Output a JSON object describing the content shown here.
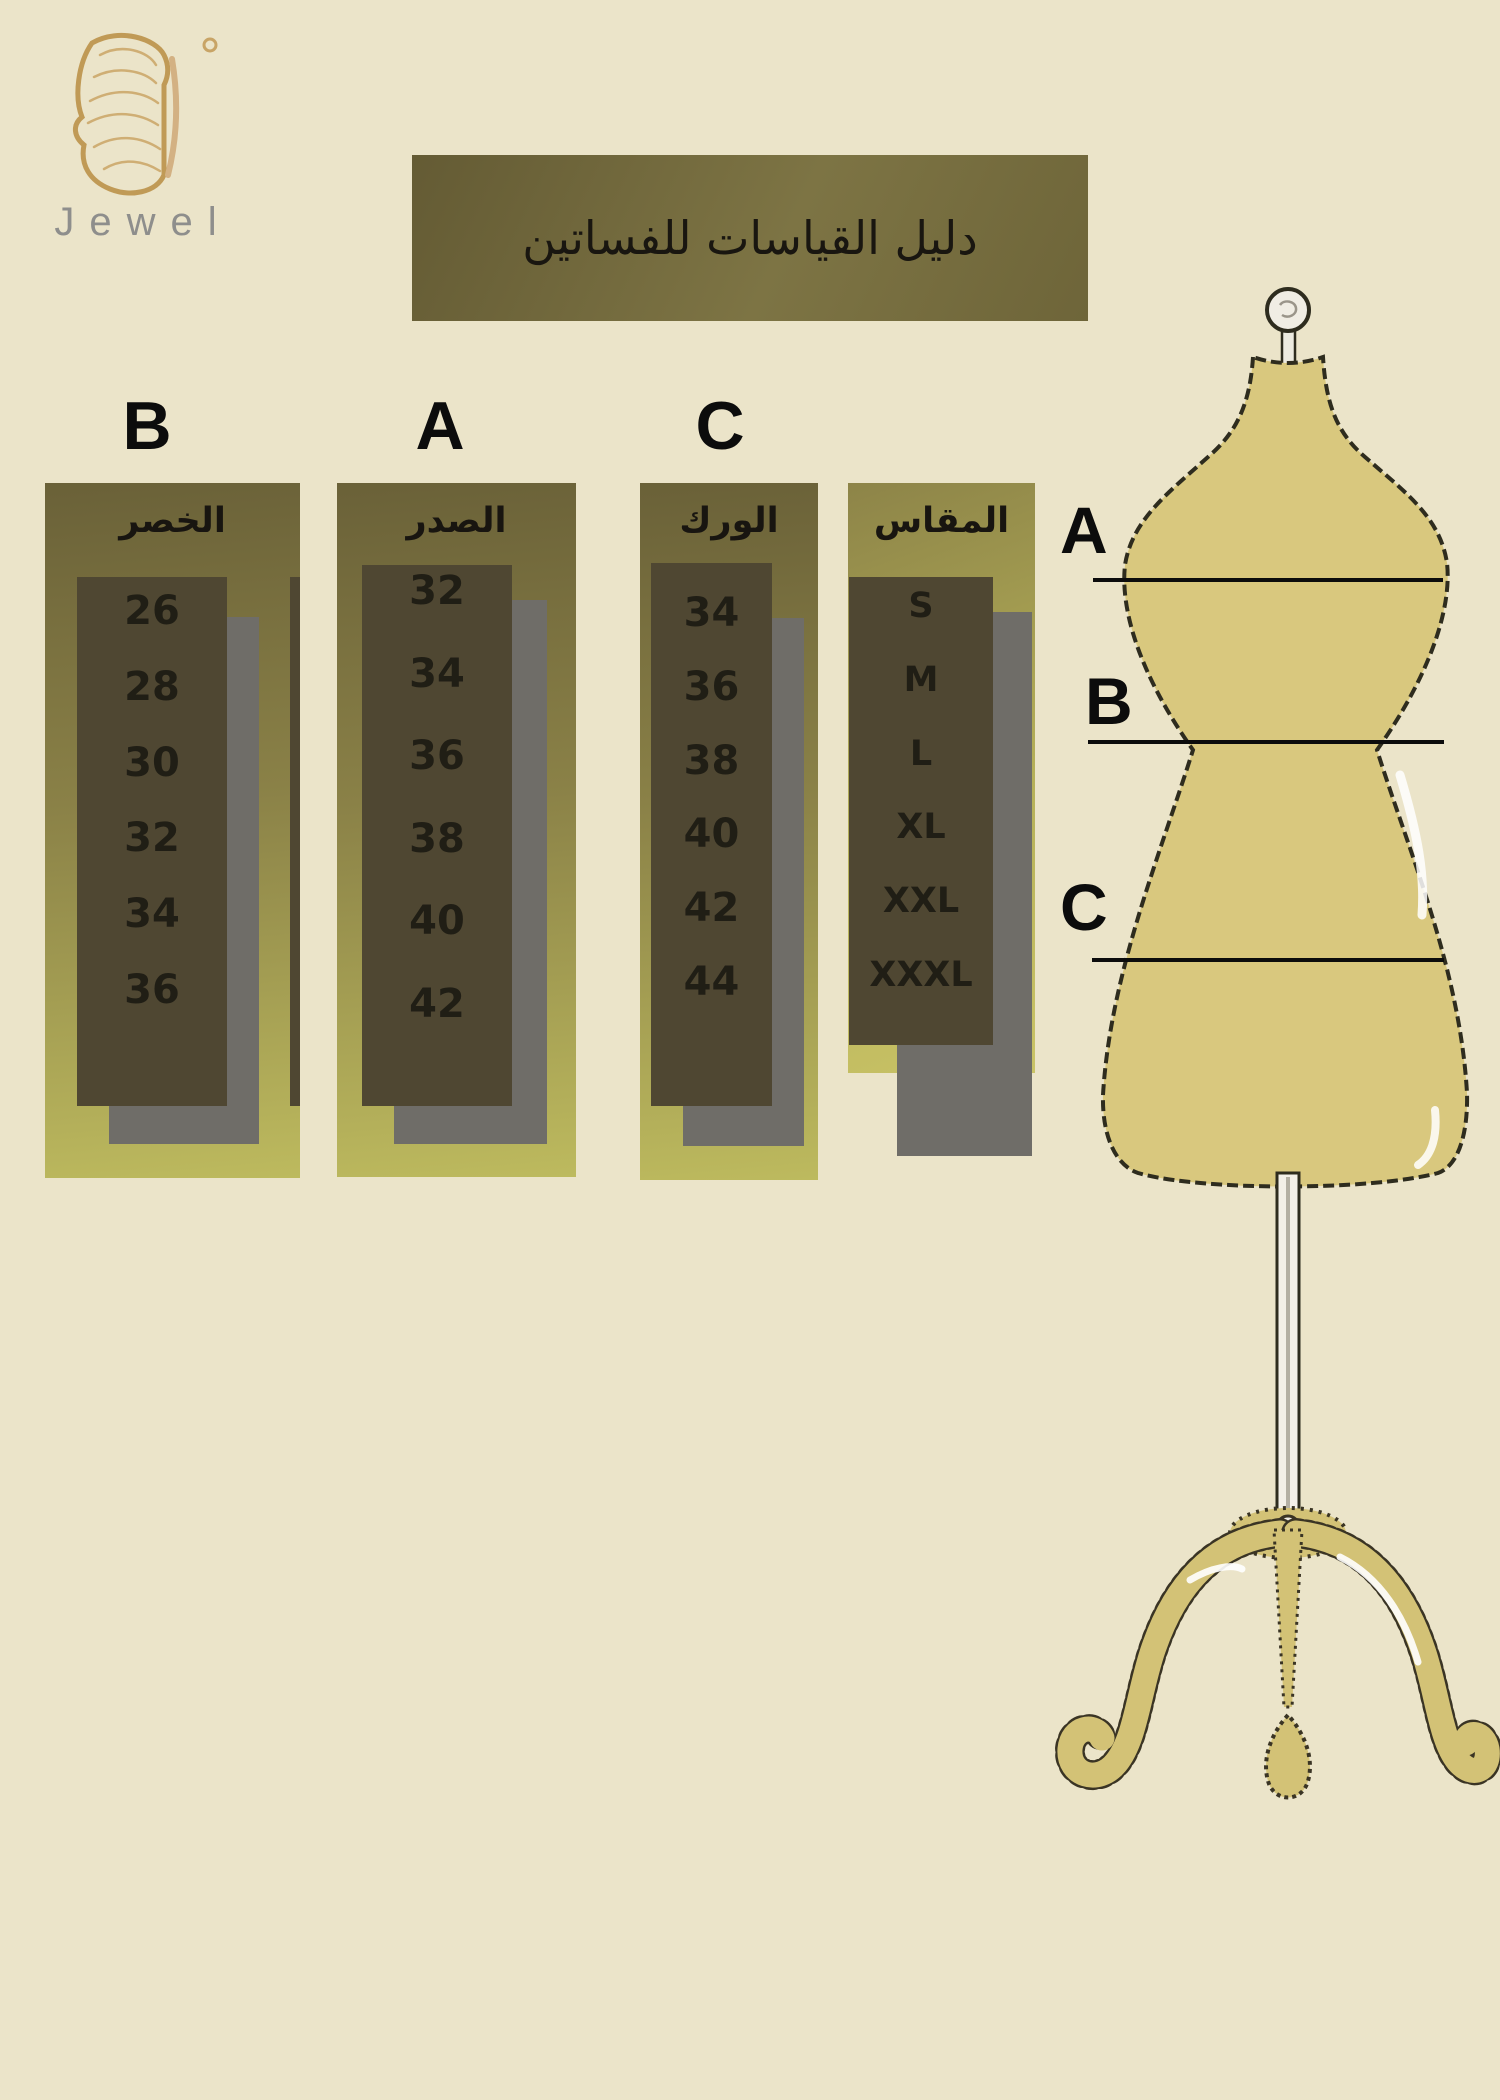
{
  "brand": {
    "name": "Jewel",
    "logo_icon": "butterfly-wing-icon"
  },
  "title": "دليل القياسات للفساتين",
  "size_chart": {
    "columns": [
      {
        "id": "waist",
        "letter": "B",
        "header": "الخصر",
        "values": [
          "26",
          "28",
          "30",
          "32",
          "34",
          "36"
        ]
      },
      {
        "id": "bust",
        "letter": "A",
        "header": "الصدر",
        "values": [
          "32",
          "34",
          "36",
          "38",
          "40",
          "42"
        ]
      },
      {
        "id": "hip",
        "letter": "C",
        "header": "الورك",
        "values": [
          "34",
          "36",
          "38",
          "40",
          "42",
          "44"
        ]
      },
      {
        "id": "size",
        "letter": "",
        "header": "المقاس",
        "values": [
          "S",
          "M",
          "L",
          "XL",
          "XXL",
          "XXXL"
        ]
      }
    ]
  },
  "mannequin": {
    "markers": [
      {
        "letter": "A"
      },
      {
        "letter": "B"
      },
      {
        "letter": "C"
      }
    ]
  },
  "colors": {
    "background": "#ebe4c9",
    "banner_olive": "#7d7444",
    "panel_gradient_top": "#6a6138",
    "panel_gradient_bottom": "#bdba5e",
    "inner_box": "#4f4732",
    "shadow_gray": "#6f6d68",
    "text_dark": "#1b1912",
    "mannequin_body": "#d9c87e",
    "stand_gold": "#d3c276",
    "logo_gold": "#c8a466",
    "brand_text_gray": "#8e8e8c"
  }
}
